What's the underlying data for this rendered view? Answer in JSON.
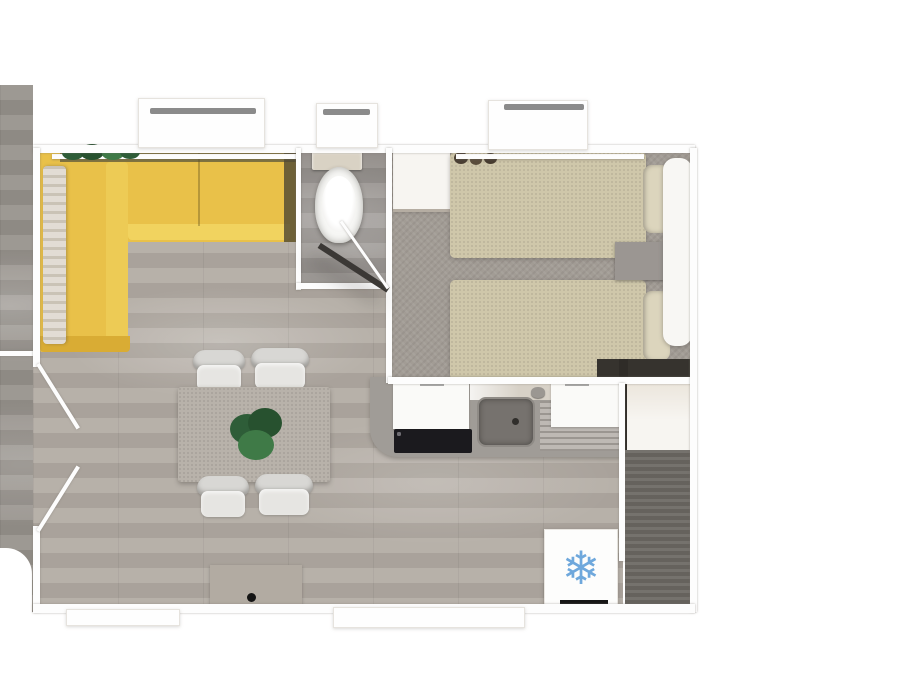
{
  "scene": {
    "kind": "3d-floor-plan-top-view",
    "description": "Top-down 3D render of a small mobile-home floor plan with living-dining area, bathroom, twin bedroom, kitchen and wardrobe room",
    "visible_text": "none"
  },
  "palette": {
    "canvas_white": "#ffffff",
    "wall_white": "#fdfdfd",
    "window_bar_gray": "#8b8b8b",
    "deck_floor": "#96918b",
    "wood_floor": "#b2aba3",
    "bath_floor": "#8e8985",
    "carpet_gray": "#a29c95",
    "storage_floor": "#6e6a65",
    "sofa_yellow": "#e9c149",
    "sofa_yellow_light": "#f1d35f",
    "sofa_yellow_deep": "#d9ac34",
    "sofa_back_shadow": "#6e653d",
    "sofa_side_shadow": "#4d4733",
    "armrest_wood": "#d8d1c5",
    "toilet_tank": "#d9d2c4",
    "toilet_white": "#f7f7f5",
    "bed_beige": "#cfc7aa",
    "pillow_beige": "#dcd5bd",
    "nightstand_gray": "#9b9692",
    "headboard_white": "#f8f7f4",
    "wardrobe_white": "#f7f5f1",
    "dark_strip": "#36332e",
    "dark_edge": "#2f2c28",
    "counter_gray": "#a09c97",
    "cabinet_white": "#fafaf8",
    "backsplash_light": "#d7d1c7",
    "sink_gray": "#76726e",
    "drain_dark": "#302e2b",
    "rack_speckle": "#b4afa9",
    "hob_black": "#1b1a1e",
    "fridge_white": "#fdfdfc",
    "fridge_handle": "#161616",
    "snowflake_blue": "#6fa8dc",
    "table_gray": "#b8b2aa",
    "chair_white": "#d8d7d4",
    "chair_seat": "#e6e5e2",
    "tv_cabinet_gray": "#b2aba2",
    "knob_black": "#141414",
    "plant_green": "#2e5d38",
    "plant_green_light": "#3f7a47",
    "decor_dark": "#4a3f33",
    "wardrobe_edge_line": "#b5ada2"
  },
  "icons": {
    "snowflake": {
      "name": "snowflake-icon",
      "glyph": "❄",
      "meaning": "refrigerator-freezer position",
      "color": "#6fa8dc"
    }
  },
  "rooms": [
    {
      "name": "living-dining-area",
      "floor": "light wood planks"
    },
    {
      "name": "kitchen",
      "floor": "light wood planks"
    },
    {
      "name": "bathroom",
      "floor": "dark gray"
    },
    {
      "name": "twin-bedroom",
      "floor": "gray carpet"
    },
    {
      "name": "wardrobe-storage-room",
      "floor": "dark wood"
    },
    {
      "name": "outdoor-deck-strip",
      "floor": "gray wood"
    }
  ],
  "furniture": [
    "yellow L-shaped corner sofa with wooden armrest",
    "plant on living-room windowsill",
    "dining table with centerpiece plant",
    "four upholstered dining chairs",
    "TV / storage cabinet at bottom wall",
    "toilet with cistern",
    "bedroom wardrobe cabinet",
    "two single beds with pillows",
    "shared headboard panel",
    "nightstand between beds",
    "kitchen counter with left and right cabinets",
    "four-burner gas hob",
    "kitchen sink with faucet and drain",
    "draining rack area",
    "refrigerator marked with snowflake",
    "right-side wardrobe cabinet",
    "double entrance door (left wall, swing marks)",
    "bathroom door (open leaf with shadow)"
  ],
  "openings": {
    "top_windows": 3,
    "bottom_windows": 2,
    "left_double_door": 1,
    "bathroom_door": 1
  }
}
